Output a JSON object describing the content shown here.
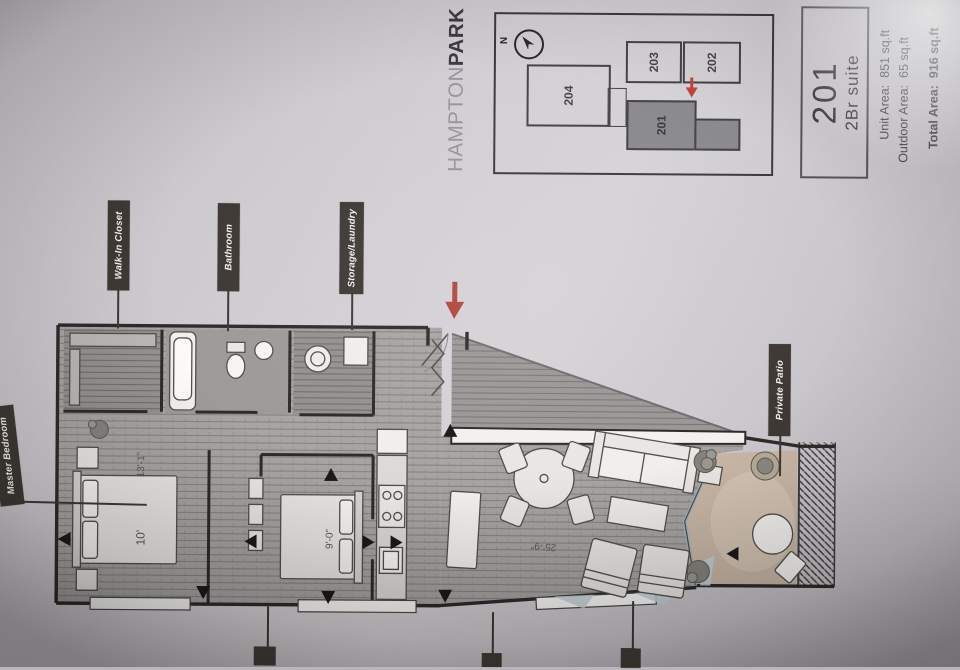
{
  "title_block": {
    "unit_number": "201",
    "unit_type": "2Br suite",
    "unit_area_label": "Unit Area:",
    "unit_area_value": "851 sq.ft",
    "outdoor_area_label": "Outdoor Area:",
    "outdoor_area_value": "65 sq.ft",
    "total_area_label": "Total Area:",
    "total_area_value": "916 sq.ft"
  },
  "brand": {
    "name_light": "HAMPTON",
    "name_bold": "PARK"
  },
  "keyplan": {
    "north_label": "N",
    "units": [
      {
        "id": "204"
      },
      {
        "id": "203"
      },
      {
        "id": "202"
      },
      {
        "id": "201"
      }
    ],
    "highlighted_unit": "201",
    "highlight_color": "#8b8a8d",
    "marker_color": "#c2443a"
  },
  "floorplan": {
    "labels": {
      "walk_in_closet": "Walk-In Closet",
      "bathroom": "Bathroom",
      "storage_laundry": "Storage/Laundry",
      "master_bedroom": "Master Bedroom",
      "private_patio": "Private Patio"
    },
    "dimensions": {
      "master_room_width": "13'-1\"",
      "master_bed": "10'",
      "bedroom2_bed": "9'-0\"",
      "living_length": "25'-9\""
    },
    "entry_arrow_color": "#b2453c"
  },
  "colors": {
    "paper": "#d0cdd2",
    "wall": "#2e2b29",
    "flag": "#3e3934",
    "wood_floor": "#a7a4a3",
    "patio_floor": "#c8b7a6"
  }
}
